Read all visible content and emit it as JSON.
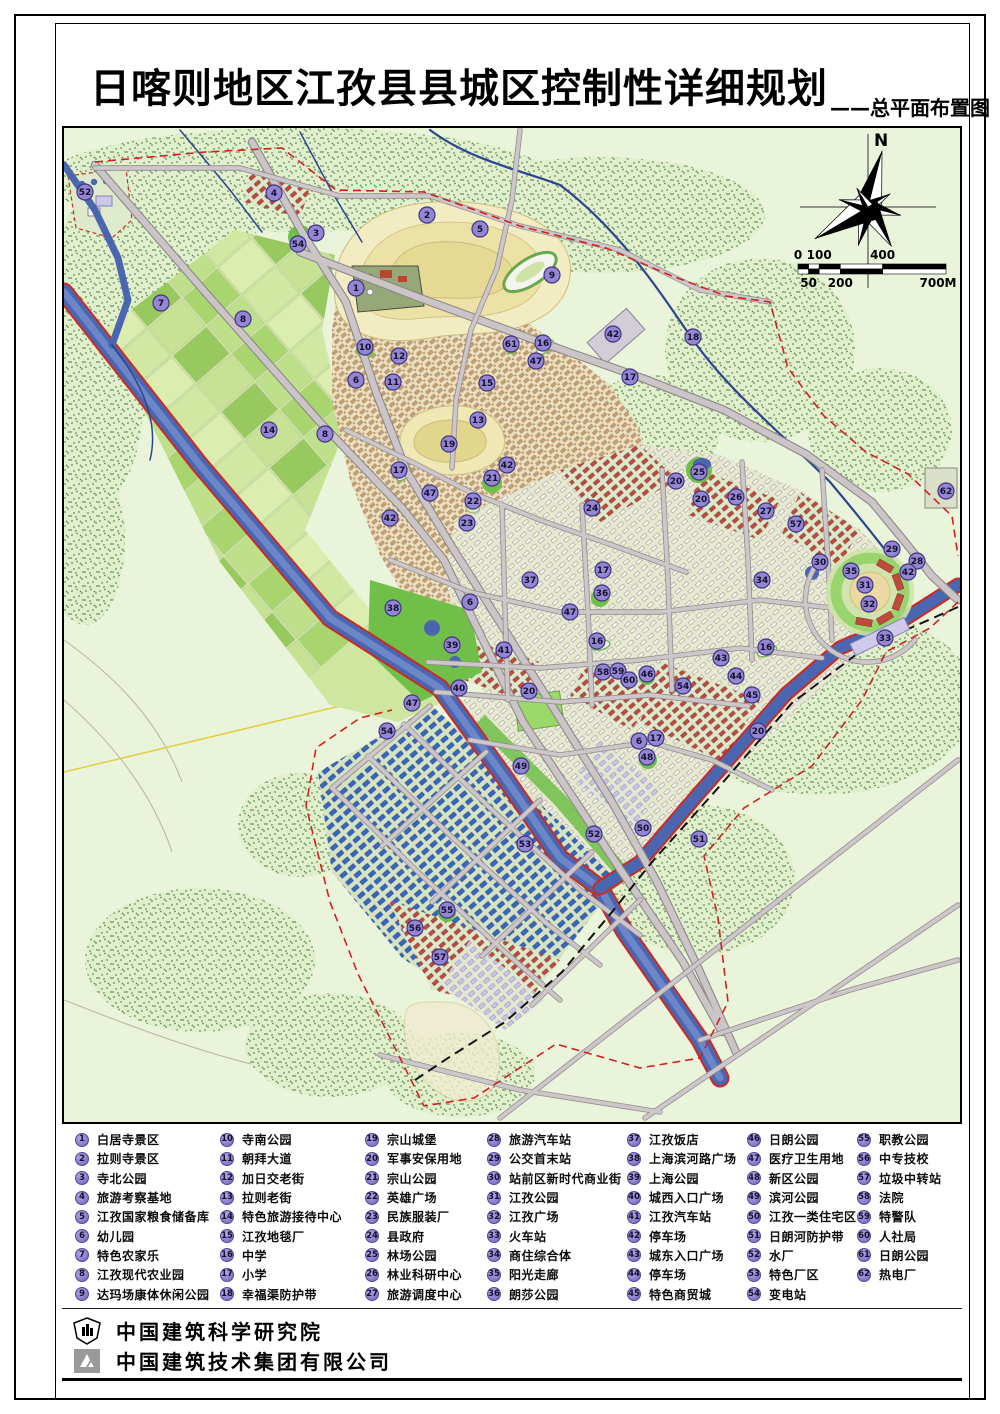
{
  "header": {
    "title": "日喀则地区江孜县县城区控制性详细规划",
    "subtitle": "——总平面布置图"
  },
  "compass": {
    "north_label": "N"
  },
  "scale_bar": {
    "top_labels": [
      "0",
      "100",
      "400"
    ],
    "bottom_labels": [
      "50",
      "200",
      "700M"
    ]
  },
  "legend": {
    "items": [
      {
        "n": 1,
        "label": "白居寺景区"
      },
      {
        "n": 2,
        "label": "拉则寺景区"
      },
      {
        "n": 3,
        "label": "寺北公园"
      },
      {
        "n": 4,
        "label": "旅游考察基地"
      },
      {
        "n": 5,
        "label": "江孜国家粮食储备库"
      },
      {
        "n": 6,
        "label": "幼儿园"
      },
      {
        "n": 7,
        "label": "特色农家乐"
      },
      {
        "n": 8,
        "label": "江孜现代农业园"
      },
      {
        "n": 9,
        "label": "达玛场康体休闲公园"
      },
      {
        "n": 10,
        "label": "寺南公园"
      },
      {
        "n": 11,
        "label": "朝拜大道"
      },
      {
        "n": 12,
        "label": "加日交老街"
      },
      {
        "n": 13,
        "label": "拉则老街"
      },
      {
        "n": 14,
        "label": "特色旅游接待中心"
      },
      {
        "n": 15,
        "label": "江孜地毯厂"
      },
      {
        "n": 16,
        "label": "中学"
      },
      {
        "n": 17,
        "label": "小学"
      },
      {
        "n": 18,
        "label": "幸福渠防护带"
      },
      {
        "n": 19,
        "label": "宗山城堡"
      },
      {
        "n": 20,
        "label": "军事安保用地"
      },
      {
        "n": 21,
        "label": "宗山公园"
      },
      {
        "n": 22,
        "label": "英雄广场"
      },
      {
        "n": 23,
        "label": "民族服装厂"
      },
      {
        "n": 24,
        "label": "县政府"
      },
      {
        "n": 25,
        "label": "林场公园"
      },
      {
        "n": 26,
        "label": "林业科研中心"
      },
      {
        "n": 27,
        "label": "旅游调度中心"
      },
      {
        "n": 28,
        "label": "旅游汽车站"
      },
      {
        "n": 29,
        "label": "公交首末站"
      },
      {
        "n": 30,
        "label": "站前区新时代商业街"
      },
      {
        "n": 31,
        "label": "江孜公园"
      },
      {
        "n": 32,
        "label": "江孜广场"
      },
      {
        "n": 33,
        "label": "火车站"
      },
      {
        "n": 34,
        "label": "商住综合体"
      },
      {
        "n": 35,
        "label": "阳光走廊"
      },
      {
        "n": 36,
        "label": "朗莎公园"
      },
      {
        "n": 37,
        "label": "江孜饭店"
      },
      {
        "n": 38,
        "label": "上海滨河路广场"
      },
      {
        "n": 39,
        "label": "上海公园"
      },
      {
        "n": 40,
        "label": "城西入口广场"
      },
      {
        "n": 41,
        "label": "江孜汽车站"
      },
      {
        "n": 42,
        "label": "停车场"
      },
      {
        "n": 43,
        "label": "城东入口广场"
      },
      {
        "n": 44,
        "label": "停车场"
      },
      {
        "n": 45,
        "label": "特色商贸城"
      },
      {
        "n": 46,
        "label": "日朗公园"
      },
      {
        "n": 47,
        "label": "医疗卫生用地"
      },
      {
        "n": 48,
        "label": "新区公园"
      },
      {
        "n": 49,
        "label": "滨河公园"
      },
      {
        "n": 50,
        "label": "江孜一类住宅区"
      },
      {
        "n": 51,
        "label": "日朗河防护带"
      },
      {
        "n": 52,
        "label": "水厂"
      },
      {
        "n": 53,
        "label": "特色厂区"
      },
      {
        "n": 54,
        "label": "变电站"
      },
      {
        "n": 55,
        "label": "职教公园"
      },
      {
        "n": 56,
        "label": "中专技校"
      },
      {
        "n": 57,
        "label": "垃圾中转站"
      },
      {
        "n": 58,
        "label": "法院"
      },
      {
        "n": 59,
        "label": "特警队"
      },
      {
        "n": 60,
        "label": "人社局"
      },
      {
        "n": 61,
        "label": "日朗公园"
      },
      {
        "n": 62,
        "label": "热电厂"
      }
    ]
  },
  "map_markers": [
    {
      "n": 1,
      "x": 356,
      "y": 288
    },
    {
      "n": 2,
      "x": 427,
      "y": 215
    },
    {
      "n": 3,
      "x": 316,
      "y": 233
    },
    {
      "n": 4,
      "x": 274,
      "y": 193
    },
    {
      "n": 5,
      "x": 480,
      "y": 229
    },
    {
      "n": 6,
      "x": 356,
      "y": 380
    },
    {
      "n": 6,
      "x": 470,
      "y": 602
    },
    {
      "n": 6,
      "x": 639,
      "y": 741
    },
    {
      "n": 7,
      "x": 161,
      "y": 303
    },
    {
      "n": 8,
      "x": 243,
      "y": 319
    },
    {
      "n": 8,
      "x": 325,
      "y": 434
    },
    {
      "n": 9,
      "x": 552,
      "y": 275
    },
    {
      "n": 10,
      "x": 365,
      "y": 347
    },
    {
      "n": 11,
      "x": 393,
      "y": 382
    },
    {
      "n": 12,
      "x": 399,
      "y": 356
    },
    {
      "n": 13,
      "x": 478,
      "y": 420
    },
    {
      "n": 14,
      "x": 269,
      "y": 430
    },
    {
      "n": 15,
      "x": 487,
      "y": 383
    },
    {
      "n": 16,
      "x": 543,
      "y": 343
    },
    {
      "n": 16,
      "x": 597,
      "y": 641
    },
    {
      "n": 16,
      "x": 766,
      "y": 647
    },
    {
      "n": 17,
      "x": 630,
      "y": 377
    },
    {
      "n": 17,
      "x": 399,
      "y": 470
    },
    {
      "n": 17,
      "x": 603,
      "y": 570
    },
    {
      "n": 17,
      "x": 656,
      "y": 738
    },
    {
      "n": 18,
      "x": 693,
      "y": 337
    },
    {
      "n": 19,
      "x": 449,
      "y": 444
    },
    {
      "n": 20,
      "x": 676,
      "y": 481
    },
    {
      "n": 20,
      "x": 701,
      "y": 499
    },
    {
      "n": 20,
      "x": 529,
      "y": 691
    },
    {
      "n": 20,
      "x": 758,
      "y": 731
    },
    {
      "n": 21,
      "x": 492,
      "y": 478
    },
    {
      "n": 22,
      "x": 473,
      "y": 501
    },
    {
      "n": 23,
      "x": 467,
      "y": 523
    },
    {
      "n": 24,
      "x": 592,
      "y": 508
    },
    {
      "n": 25,
      "x": 699,
      "y": 472
    },
    {
      "n": 26,
      "x": 736,
      "y": 497
    },
    {
      "n": 27,
      "x": 766,
      "y": 511
    },
    {
      "n": 28,
      "x": 917,
      "y": 561
    },
    {
      "n": 29,
      "x": 892,
      "y": 549
    },
    {
      "n": 30,
      "x": 820,
      "y": 562
    },
    {
      "n": 31,
      "x": 865,
      "y": 585
    },
    {
      "n": 32,
      "x": 869,
      "y": 604
    },
    {
      "n": 33,
      "x": 885,
      "y": 638
    },
    {
      "n": 34,
      "x": 762,
      "y": 580
    },
    {
      "n": 35,
      "x": 851,
      "y": 571
    },
    {
      "n": 36,
      "x": 602,
      "y": 593
    },
    {
      "n": 37,
      "x": 530,
      "y": 580
    },
    {
      "n": 38,
      "x": 393,
      "y": 608
    },
    {
      "n": 39,
      "x": 452,
      "y": 645
    },
    {
      "n": 40,
      "x": 459,
      "y": 688
    },
    {
      "n": 41,
      "x": 504,
      "y": 650
    },
    {
      "n": 42,
      "x": 613,
      "y": 334
    },
    {
      "n": 42,
      "x": 507,
      "y": 465
    },
    {
      "n": 42,
      "x": 390,
      "y": 518
    },
    {
      "n": 42,
      "x": 908,
      "y": 572
    },
    {
      "n": 43,
      "x": 721,
      "y": 658
    },
    {
      "n": 44,
      "x": 736,
      "y": 676
    },
    {
      "n": 45,
      "x": 752,
      "y": 695
    },
    {
      "n": 46,
      "x": 647,
      "y": 674
    },
    {
      "n": 47,
      "x": 536,
      "y": 361
    },
    {
      "n": 47,
      "x": 430,
      "y": 493
    },
    {
      "n": 47,
      "x": 570,
      "y": 612
    },
    {
      "n": 47,
      "x": 412,
      "y": 703
    },
    {
      "n": 48,
      "x": 647,
      "y": 757
    },
    {
      "n": 49,
      "x": 521,
      "y": 766
    },
    {
      "n": 50,
      "x": 643,
      "y": 828
    },
    {
      "n": 51,
      "x": 699,
      "y": 839
    },
    {
      "n": 52,
      "x": 85,
      "y": 192
    },
    {
      "n": 52,
      "x": 594,
      "y": 834
    },
    {
      "n": 53,
      "x": 525,
      "y": 844
    },
    {
      "n": 54,
      "x": 298,
      "y": 244
    },
    {
      "n": 54,
      "x": 683,
      "y": 686
    },
    {
      "n": 54,
      "x": 387,
      "y": 731
    },
    {
      "n": 55,
      "x": 447,
      "y": 910
    },
    {
      "n": 56,
      "x": 415,
      "y": 928
    },
    {
      "n": 57,
      "x": 796,
      "y": 524
    },
    {
      "n": 57,
      "x": 440,
      "y": 957
    },
    {
      "n": 58,
      "x": 603,
      "y": 672
    },
    {
      "n": 59,
      "x": 618,
      "y": 671
    },
    {
      "n": 60,
      "x": 629,
      "y": 680
    },
    {
      "n": 61,
      "x": 511,
      "y": 344
    },
    {
      "n": 62,
      "x": 946,
      "y": 491
    }
  ],
  "footer": {
    "org1": "中国建筑科学研究院",
    "org2": "中国建筑技术集团有限公司"
  },
  "colors": {
    "map_background": "#eaf4da",
    "river": "#4a66b0",
    "river_edge_red": "#cc2a22",
    "marker_fill": "#9486d2",
    "marker_stroke": "#3f3480",
    "road": "#cbc5c7",
    "hill": "#f2ecc2",
    "park_green": "#6fbf49",
    "industrial_blue": "#3766c2",
    "building_red": "#c04a3e",
    "boundary_red": "#d42020"
  }
}
